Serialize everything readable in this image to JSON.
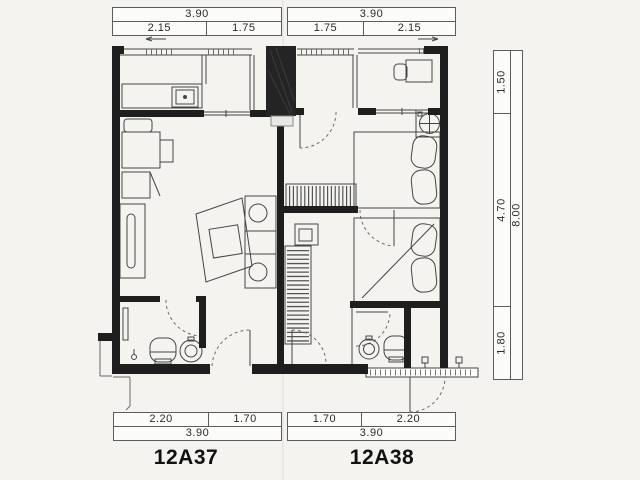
{
  "units": {
    "left": {
      "label": "12A37"
    },
    "right": {
      "label": "12A38"
    }
  },
  "dims": {
    "top_left": {
      "total": "3.90",
      "p1": "2.15",
      "p2": "1.75"
    },
    "top_right": {
      "total": "3.90",
      "p1": "1.75",
      "p2": "2.15"
    },
    "bottom_left": {
      "p1": "2.20",
      "p2": "1.70",
      "total": "3.90"
    },
    "bottom_right": {
      "p1": "1.70",
      "p2": "2.20",
      "total": "3.90"
    },
    "right_side": {
      "p1": "1.50",
      "p2": "4.70",
      "p3": "1.80",
      "total": "8.00"
    }
  },
  "colors": {
    "paper": "#f4f3f0",
    "wall": "#1e1e1e",
    "line": "#454545",
    "text": "#222222"
  }
}
